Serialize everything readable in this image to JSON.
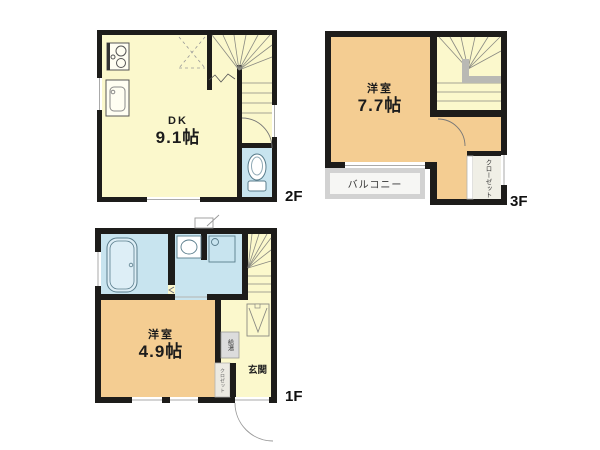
{
  "colors": {
    "wall": "#1d1c1a",
    "room_yellow": "#fbf8cc",
    "room_orange": "#f4cd92",
    "room_blue": "#c8e4ef",
    "balcony_gray": "#d2d2d2"
  },
  "floors": {
    "f1": {
      "floor_label": "1F",
      "room_label": "洋室",
      "size_label": "4.9帖",
      "entrance_label": "玄関",
      "water_heater_label": "給湯",
      "closet_label": "クロゼット"
    },
    "f2": {
      "floor_label": "2F",
      "room_label": "DK",
      "size_label": "9.1帖"
    },
    "f3": {
      "floor_label": "3F",
      "room_label": "洋室",
      "size_label": "7.7帖",
      "balcony_label": "バルコニー",
      "closet_label": "クローゼット"
    }
  }
}
